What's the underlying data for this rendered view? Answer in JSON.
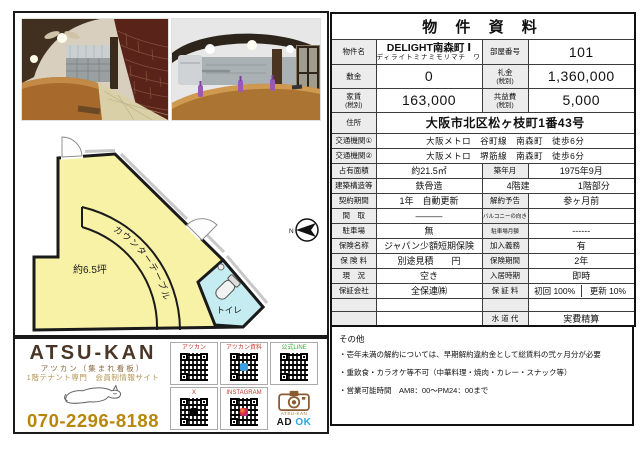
{
  "header": {
    "title": "物 件 資 料"
  },
  "property": {
    "name_label": "物件名",
    "name": "DELIGHT南森町 Ⅰ",
    "name_kana": "ディライトミナミモリマチ　ワン",
    "room_label": "部屋番号",
    "room": "101",
    "deposit_label": "敷金",
    "deposit": "0",
    "key_label": "礼金",
    "key": "1,360,000",
    "rent_label": "家賃",
    "rent": "163,000",
    "fee_label": "共益費",
    "fee": "5,000",
    "tax_note": "(税別)"
  },
  "address": {
    "label": "住所",
    "value": "大阪市北区松ヶ枝町1番43号"
  },
  "access": [
    {
      "label": "交通機関①",
      "value": "大阪メトロ　谷町線　南森町　徒歩6分"
    },
    {
      "label": "交通機関②",
      "value": "大阪メトロ　堺筋線　南森町　徒歩6分"
    }
  ],
  "details": {
    "area_label": "占有面積",
    "area": "約21.5㎡",
    "built_label": "築年月",
    "built": "1975年9月",
    "structure_label": "建築構造等",
    "structure": "鉄骨造",
    "floors": "4階建",
    "floor_part": "1階部分",
    "contract_label": "契約期間",
    "contract": "1年　自動更新",
    "notice_label": "解約予告",
    "notice": "参ヶ月前",
    "layout_label": "間　取",
    "layout": "―――",
    "balcony_label": "バルコニーの向き",
    "balcony": "",
    "parking_label": "駐車場",
    "parking": "無",
    "parking_fee_label": "駐車場月額",
    "parking_fee": "------",
    "insurance_label": "保険名称",
    "insurance": "ジャパン少額短期保険",
    "duty_label": "加入義務",
    "duty": "有",
    "premium_label": "保 険 料",
    "premium": "別途見積　　円",
    "ins_term_label": "保険期間",
    "ins_term": "2年",
    "status_label": "現　況",
    "status": "空き",
    "movein_label": "入居時期",
    "movein": "即時",
    "guarantor_label": "保証会社",
    "guarantor": "全保連㈱",
    "gfee_label": "保 証 料",
    "gfee_initial": "初回 100%",
    "gfee_renewal": "更新 10%",
    "water_label": "水 道 代",
    "water": "実費精算"
  },
  "notes": {
    "title": "その他",
    "items": [
      "・壱年未満の解約については、早期解約違約金として総賃料の弐ヶ月分が必要",
      "・重飲食・カラオケ等不可（中華料理・焼肉・カレー・スナック等）",
      "・営業可能時間　AM8：00～PM24：00まで"
    ]
  },
  "floor_plan": {
    "area": "約6.5坪",
    "counter": "カウンターテーブル",
    "toilet": "トイレ",
    "north": "N"
  },
  "branding": {
    "logo": "ATSU-KAN",
    "subtitle": "アツカン（集まれ看板）",
    "tagline": "1階テナント専門　会員制情報サイト",
    "phone": "070-2296-8188",
    "camera_caption": "ATSU-KAN",
    "ad": "AD",
    "ok": "OK"
  },
  "qr": [
    {
      "label": "アツカン"
    },
    {
      "label": "アツカン資料"
    },
    {
      "label": "公式LINE"
    },
    {
      "label": "X"
    },
    {
      "label": "INSTAGRAM"
    }
  ],
  "colors": {
    "plan_room": "#f8f2a6",
    "plan_toilet": "#c5ecf0",
    "label_cell_bg": "#ececec",
    "logo_brown": "#4a3626",
    "phone_gold": "#b8860b",
    "qr_label_red": "#c2392b",
    "line_green": "#2db52d",
    "adok_blue": "#2fa3dc"
  }
}
